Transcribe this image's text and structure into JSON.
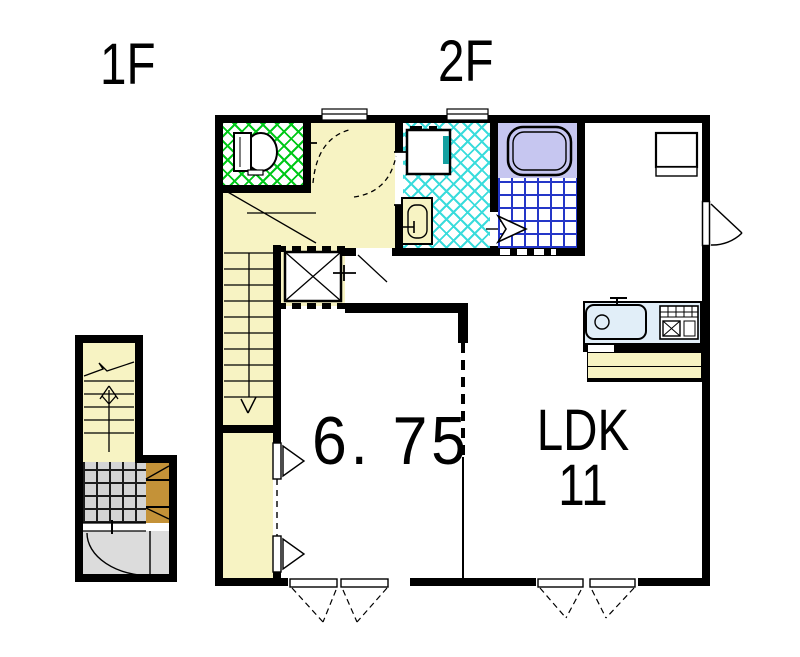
{
  "page": {
    "description": "Japanese apartment floor plan drawing: 1F entrance with staircase, 2F living floor",
    "background": "#ffffff"
  },
  "floor_labels": {
    "f1": "1F",
    "f2": "2F"
  },
  "room_labels": {
    "bedroom_size": "6. 75",
    "ldk_name": "LDK",
    "ldk_size": "11"
  },
  "palette": {
    "wall": "#000000",
    "floor_yellow": "#F7F3C3",
    "toilet_hatch_green": "#00C818",
    "washroom_hatch_cyan": "#3ADCDC",
    "bathtub_lavender": "#C6C6F0",
    "bath_tile_blue": "#2436C8",
    "kitchen_counter_blue": "#E1EEF8",
    "entrance_tile_gray": "#D4D4D4",
    "porch_gray": "#DCDCDC",
    "shoe_cabinet_tan": "#C49238",
    "washer_accent_teal": "#14A0A0"
  },
  "icons": {
    "toilet-icon": "toilet tank and bowl, plan view",
    "washing-machine-icon": "washing machine pan",
    "vanity-icon": "washbasin cabinet",
    "bathtub-icon": "bathtub, plan view",
    "folding-door-icon": "bath folding door arrow",
    "kitchen-sink-icon": "kitchen counter with sink and faucet",
    "stove-icon": "cooktop with burner grid",
    "stairs-up-arrow-icon": "staircase up arrow (1F)",
    "stairs-down-arrow-icon": "staircase down chevron (2F)",
    "door-swing-icon": "hinged door swing arc",
    "window-casement-icon": "double casement window swing marks",
    "closet-triangle-icon": "closet door direction triangles",
    "shaft-box-icon": "crossed box (shaft/void)"
  }
}
